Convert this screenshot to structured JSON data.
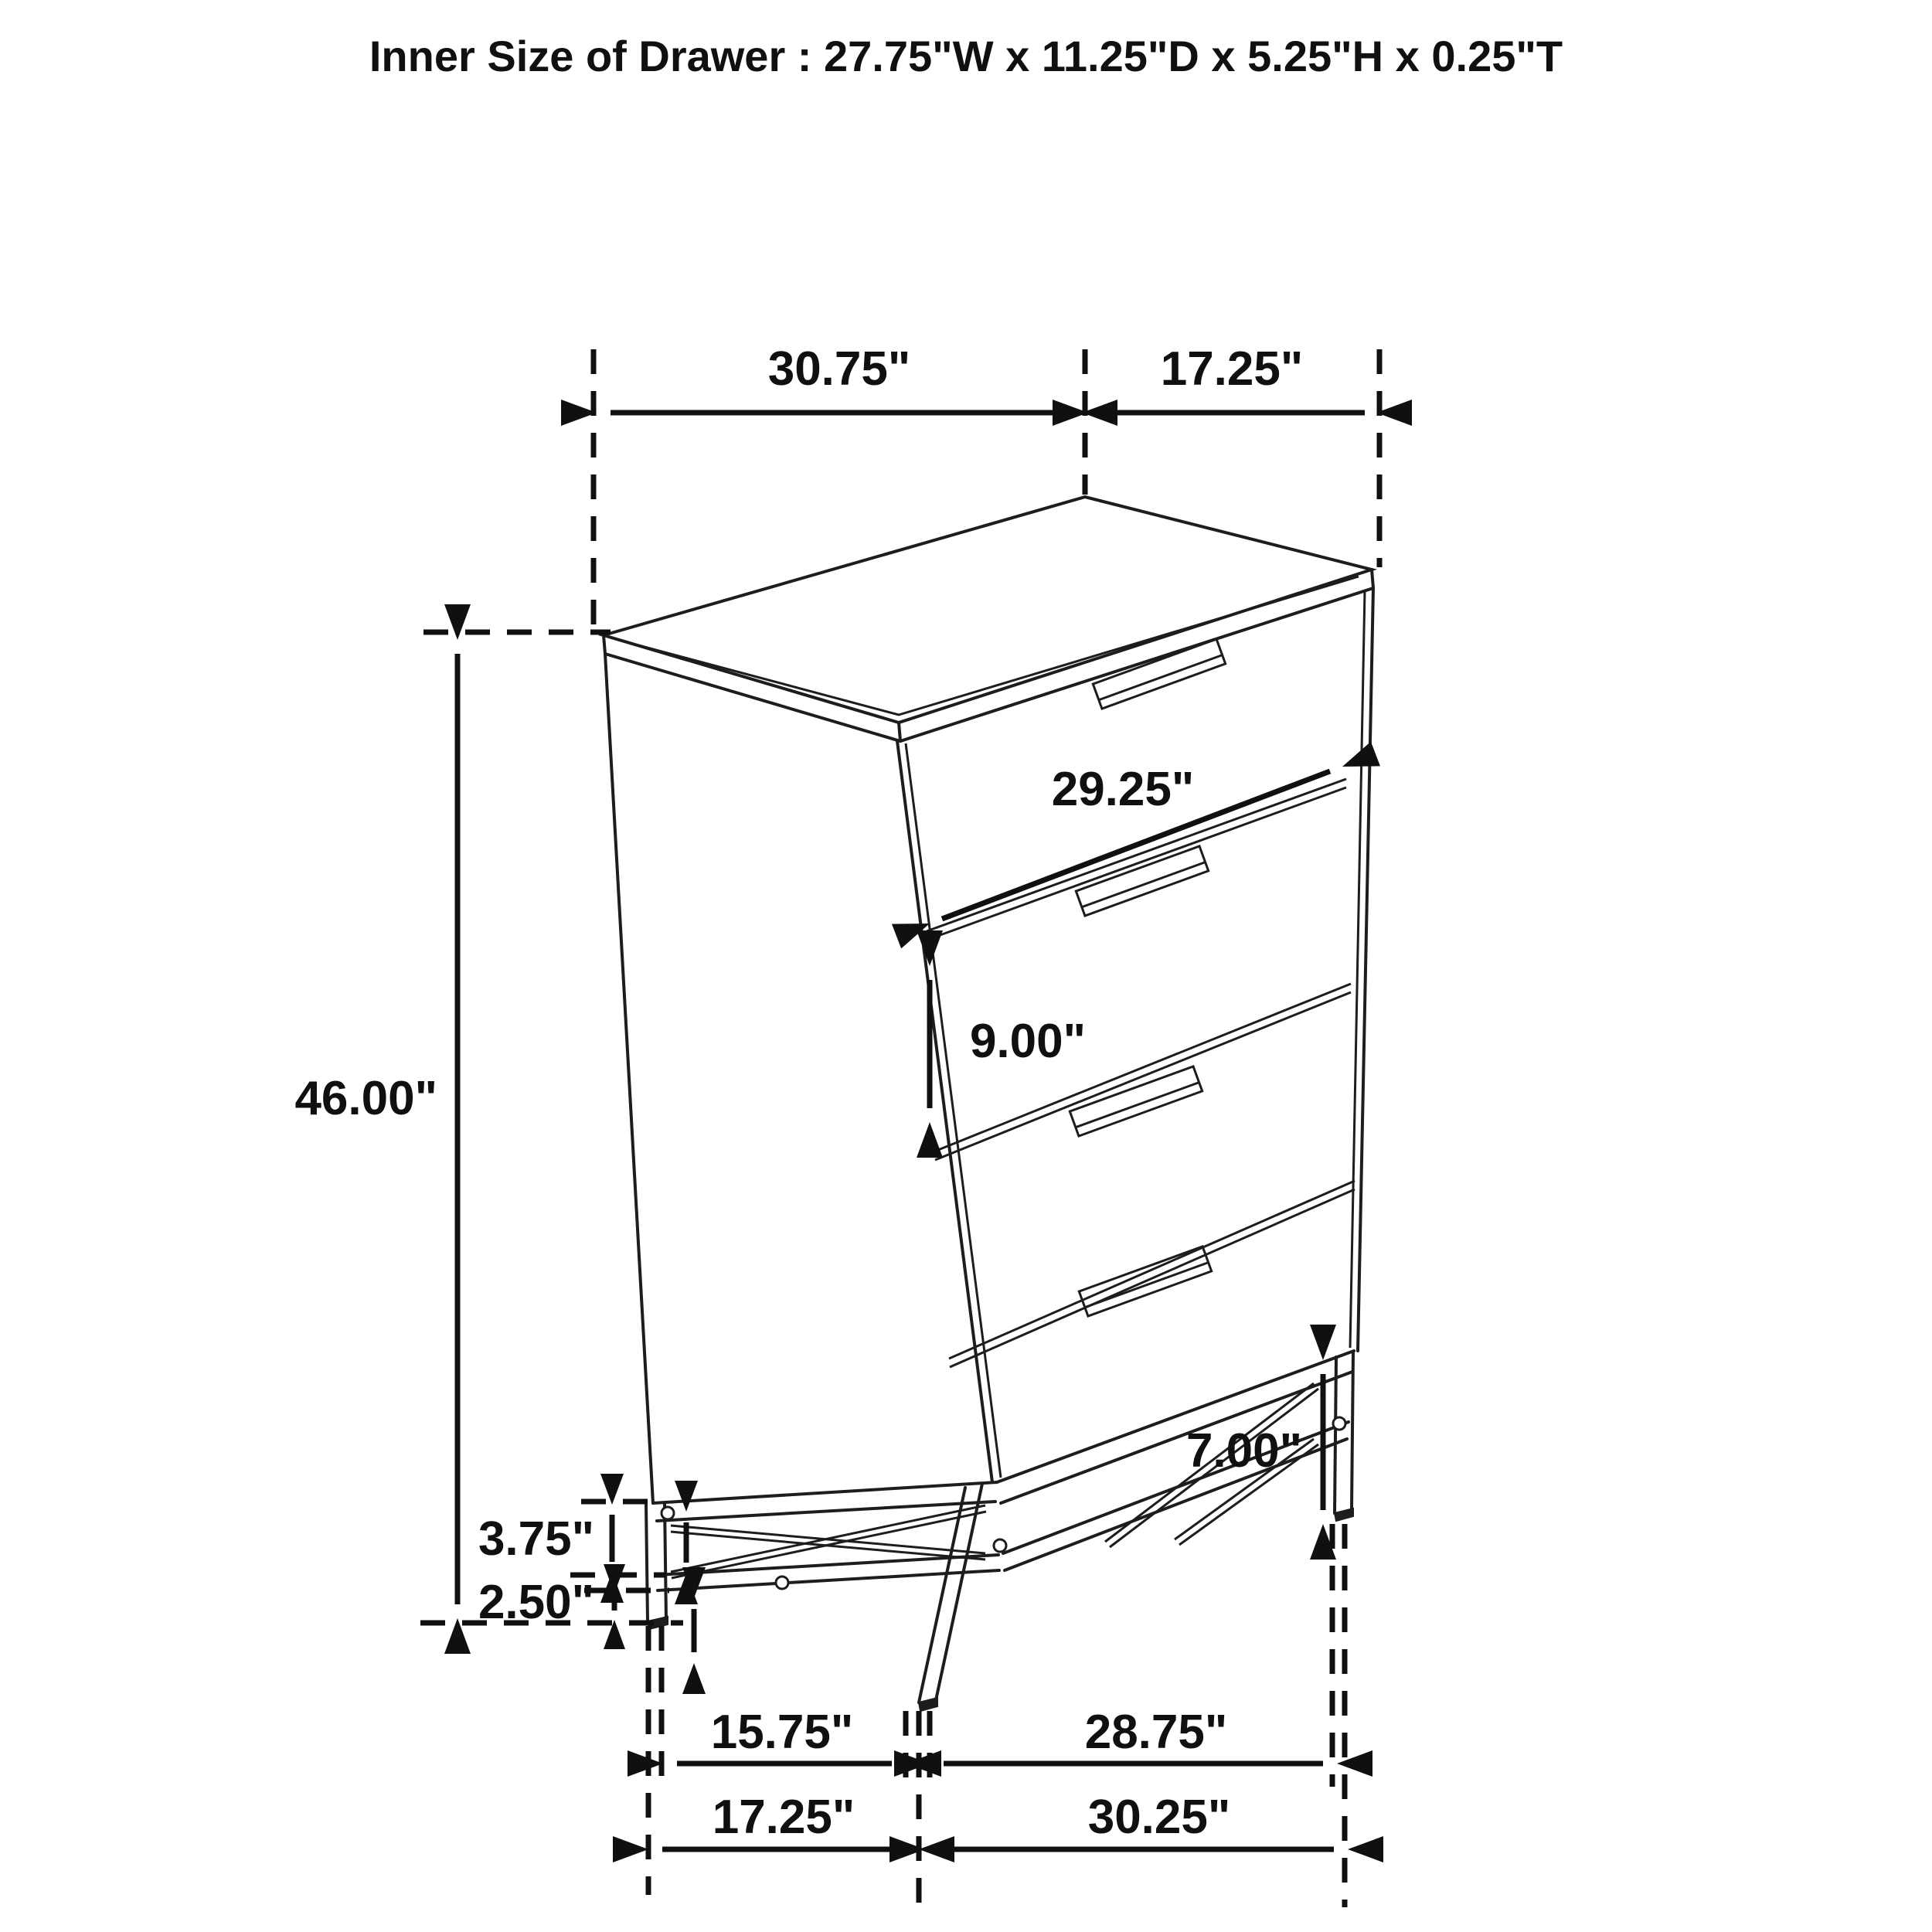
{
  "title": "Inner Size of Drawer : 27.75\"W x 11.25\"D x 5.25\"H x 0.25\"T",
  "figure": {
    "kind": "furniture dimension line drawing",
    "subject": "4-drawer chest on metal base frame"
  },
  "labels": {
    "top_width": "30.75\"",
    "top_depth": "17.25\"",
    "drawer_face_width": "29.25\"",
    "drawer_face_height": "9.00\"",
    "overall_height": "46.00\"",
    "base_upper_height": "3.75\"",
    "base_lower_height": "2.50\"",
    "base_clearance": "7.00\"",
    "feet_depth_inner": "15.75\"",
    "feet_width_inner": "28.75\"",
    "feet_depth_outer": "17.25\"",
    "feet_width_outer": "30.25\""
  },
  "colors": {
    "background": "#ffffff",
    "line": "#1d1d1d",
    "text": "#101010"
  }
}
